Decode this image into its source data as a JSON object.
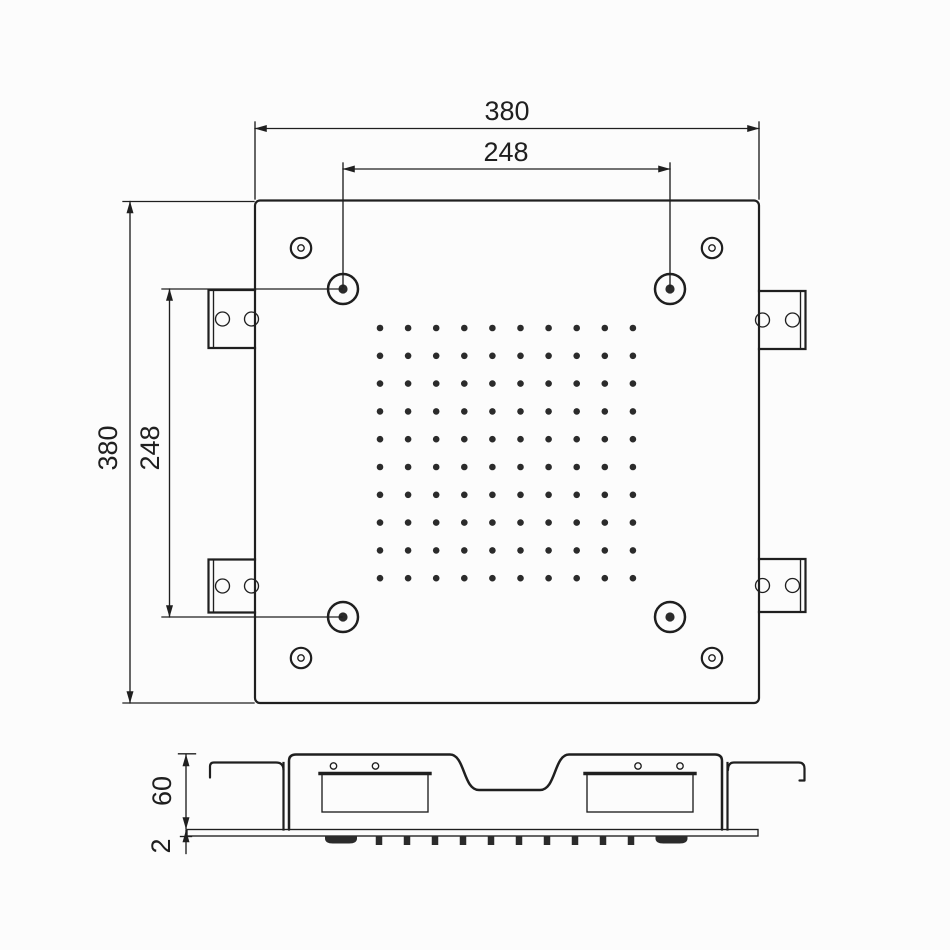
{
  "dimensions": {
    "top_width": "380",
    "top_hole_spacing": "248",
    "left_height": "380",
    "left_hole_spacing": "248",
    "side_height": "60",
    "base_thickness": "2"
  },
  "nozzle_grid": {
    "rows": 10,
    "cols": 10,
    "x_start": 380,
    "y_start": 328,
    "x_step": 28.1,
    "y_step": 27.8,
    "dot_radius": 3.3
  },
  "drain_teeth": {
    "count": 10,
    "x_center_start": 379,
    "x_step": 28,
    "y_top": 835.5,
    "width": 6.5,
    "height": 9.5
  },
  "colors": {
    "line": "#1f1f1f",
    "background": "#fcfcfc",
    "fill_dark": "#2b2b2b"
  }
}
